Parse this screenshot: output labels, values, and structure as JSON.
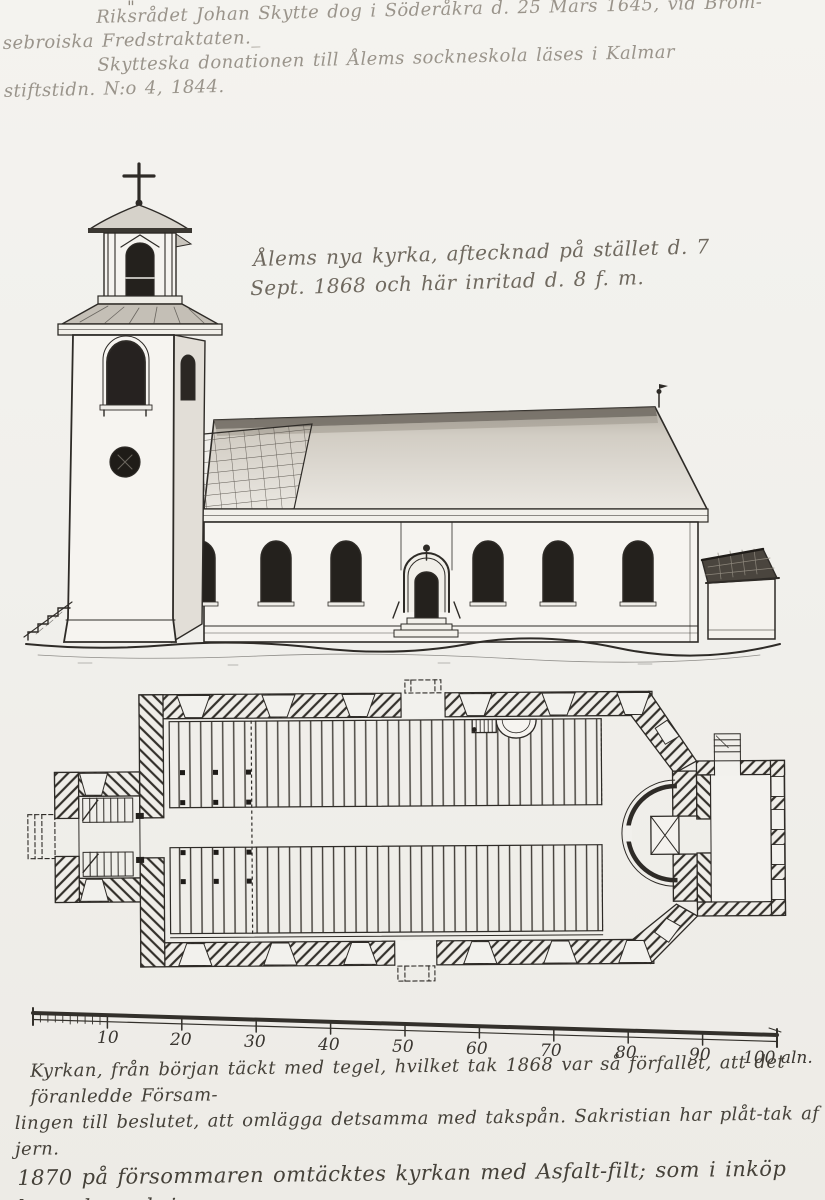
{
  "colors": {
    "paper": "#f1f0ec",
    "ink": "#2e2b27",
    "faded_ink": "#9a948b",
    "caption_ink": "#6f695f",
    "note_ink": "#454139"
  },
  "top_notes": {
    "ditto_mark": "\"",
    "lines": [
      "Riksrådet Johan Skytte dog i Söderåkra d. 25 Mars 1645, vid Bröm-",
      "sebroiska Fredstraktaten._",
      "Skytteska donationen till Ålems sockneskola läses i Kalmar",
      "stiftstidn. N:o 4, 1844."
    ]
  },
  "caption": {
    "lines": [
      "Ålems nya kyrka, aftecknad på stället d. 7",
      "Sept. 1868 och här inritad d. 8 f. m."
    ]
  },
  "scale_bar": {
    "tick_labels": [
      "10",
      "20",
      "30",
      "40",
      "50",
      "60",
      "70",
      "80",
      "90"
    ],
    "end_label": "100 aln."
  },
  "bottom_notes": {
    "lines": [
      "Kyrkan, från början täckt med tegel, hvilket tak 1868 var så förfallet, att det föranledde Försam-",
      "lingen till beslutet, att omlägga detsamma med takspån. Sakristian har plåt-tak af jern.",
      "1870 på försommaren omtäcktes kyrkan med Asfalt-filt; som i inköp kostade omkring",
      "700 Rdr."
    ]
  }
}
